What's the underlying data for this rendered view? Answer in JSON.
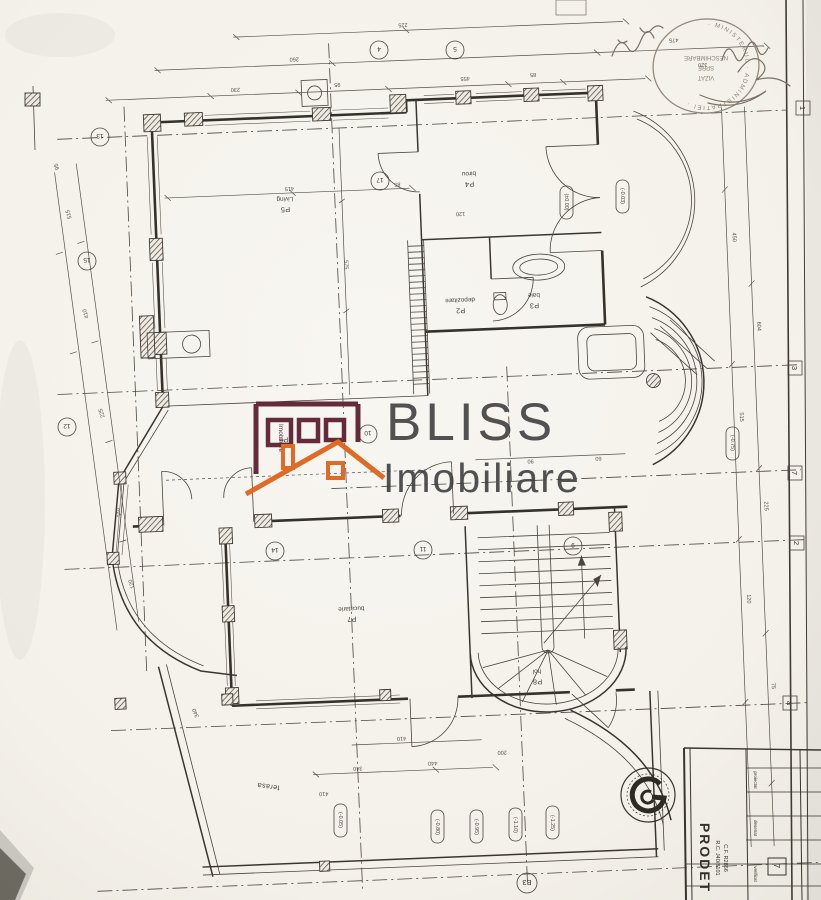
{
  "watermark": {
    "line1": "BLISS",
    "line2": "Imobiliare",
    "micro": "Imobiliare",
    "maroon": "#5f2433",
    "orange": "#e0661f",
    "grey": "#3c3c3e"
  },
  "rooms": [
    {
      "id": "P5",
      "name": "Living"
    },
    {
      "id": "P4",
      "name": "birou"
    },
    {
      "id": "P2",
      "name": "depozitare"
    },
    {
      "id": "P3",
      "name": "baie"
    },
    {
      "id": "P6",
      "name": ""
    },
    {
      "id": "P7",
      "name": "bucatarie"
    },
    {
      "id": "P8",
      "name": "hol"
    },
    {
      "id": "terasa",
      "name": "terasa"
    }
  ],
  "levels": [
    "(±0.00)",
    "(-0.03)",
    "(-0.05)",
    "(-0.75)",
    "(-0.80)",
    "(-0.95)",
    "(-1.10)",
    "(-1.25)"
  ],
  "tags": [
    "4",
    "5",
    "17",
    "10",
    "13",
    "15",
    "12",
    "14",
    "11",
    "9"
  ],
  "grid": {
    "right": [
      "1",
      "3",
      "7",
      "2",
      "a"
    ],
    "bottom": "B3"
  },
  "dims": {
    "top": [
      "225",
      "260",
      "475",
      "230",
      "95",
      "455",
      "85",
      "320"
    ],
    "right": [
      "450",
      "604",
      "515",
      "225",
      "120",
      "75"
    ],
    "left": [
      "515",
      "410",
      "225",
      "340",
      "120",
      "95"
    ],
    "inner": [
      "575",
      "415",
      "85",
      "120",
      "340",
      "90",
      "410",
      "60"
    ],
    "bottom": [
      "440",
      "410",
      "340",
      "200"
    ]
  },
  "stamp": {
    "rim": "· MINISTERUL · ADMINISTRATIEI ·",
    "inner": [
      "VIZAT",
      "SPRE",
      "NESCHIMBARE"
    ]
  },
  "titleblock": {
    "company": "PRODET",
    "reg1": "R.C. J40/8101",
    "reg2": "C.F. R2856",
    "rows": [
      "proiectat",
      "desenat",
      "verificat"
    ],
    "sheet": "7"
  }
}
